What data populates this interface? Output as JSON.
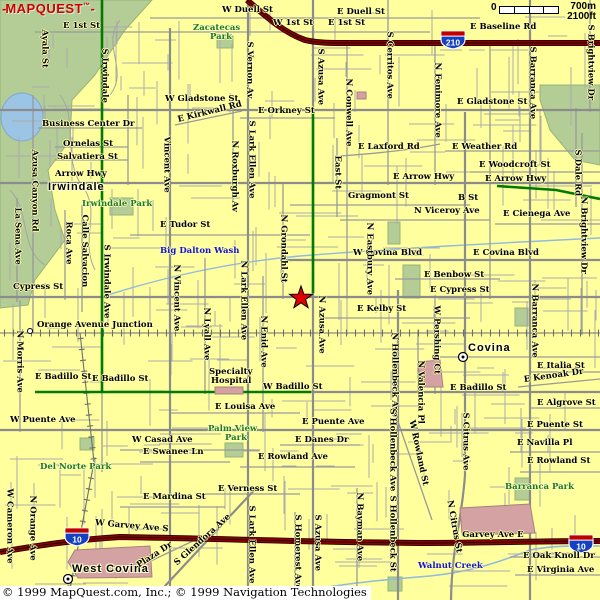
{
  "logo": {
    "prefix": "-",
    "text": "MAPQUEST",
    "tm": "™",
    "suffix": "-"
  },
  "scale": {
    "zero": "0",
    "metric": "700m",
    "imperial": "2100ft"
  },
  "copyright": {
    "text": "© 1999 MapQuest.com, Inc.; © 1999 Navigation Technologies"
  },
  "palette": {
    "background": "#FFFF9E",
    "park": "#B4CC96",
    "water": "#9CC4E4",
    "freeway": "#7E0000",
    "highlight_route": "#007A00",
    "building": "#D4A2A2",
    "road": "#909090",
    "logo_red": "#CC0000",
    "water_text": "#1414CC",
    "park_text": "#1E7A1E"
  },
  "shields": [
    {
      "number": "210",
      "x": 453,
      "y": 40
    },
    {
      "number": "10",
      "x": 77,
      "y": 537
    },
    {
      "number": "10",
      "x": 581,
      "y": 544
    }
  ],
  "star": {
    "x": 301,
    "y": 298
  },
  "markers": [
    {
      "x": 97,
      "y": 186,
      "s": "town"
    },
    {
      "x": 30,
      "y": 331,
      "s": "junction"
    },
    {
      "x": 463,
      "y": 357,
      "s": "city"
    },
    {
      "x": 68,
      "y": 579,
      "s": "city"
    }
  ],
  "labels": [
    {
      "t": "W Duell St",
      "x": 222,
      "y": 6
    },
    {
      "t": "E Duell St",
      "x": 337,
      "y": 8
    },
    {
      "t": "W 1st St",
      "x": 273,
      "y": 19
    },
    {
      "t": "E 1st St",
      "x": 328,
      "y": 19
    },
    {
      "t": "E 1st St",
      "x": 63,
      "y": 22
    },
    {
      "t": "E Baseline Rd",
      "x": 470,
      "y": 23
    },
    {
      "t": "Zacatecas",
      "k": "p",
      "x": 193,
      "y": 24
    },
    {
      "t": "Park",
      "k": "p",
      "x": 210,
      "y": 33
    },
    {
      "t": "W Gladstone St",
      "x": 165,
      "y": 95
    },
    {
      "t": "E Gladstone St",
      "x": 457,
      "y": 98
    },
    {
      "t": "E Orkney St",
      "x": 258,
      "y": 107
    },
    {
      "t": "Business Center Dr",
      "x": 42,
      "y": 120
    },
    {
      "t": "E Kirkwall Rd",
      "x": 178,
      "y": 116,
      "r": -14
    },
    {
      "t": "Ornelas St",
      "x": 63,
      "y": 140
    },
    {
      "t": "Salvatiera St",
      "x": 57,
      "y": 153
    },
    {
      "t": "E Laxford Rd",
      "x": 358,
      "y": 143
    },
    {
      "t": "E Weather Rd",
      "x": 452,
      "y": 143
    },
    {
      "t": "E Woodcroft St",
      "x": 479,
      "y": 161
    },
    {
      "t": "Arrow Hwy",
      "x": 55,
      "y": 170
    },
    {
      "t": "E Arrow Hwy",
      "x": 393,
      "y": 173
    },
    {
      "t": "E Arrow Hwy",
      "x": 485,
      "y": 175
    },
    {
      "t": "Irwindale",
      "k": "c",
      "x": 48,
      "y": 181
    },
    {
      "t": "Irwindale Park",
      "k": "p",
      "x": 82,
      "y": 200
    },
    {
      "t": "Gragmont St",
      "x": 348,
      "y": 192
    },
    {
      "t": "B St",
      "x": 458,
      "y": 194
    },
    {
      "t": "N Viceroy Ave",
      "x": 414,
      "y": 207
    },
    {
      "t": "E Cienega Ave",
      "x": 503,
      "y": 210
    },
    {
      "t": "E Tudor St",
      "x": 160,
      "y": 221
    },
    {
      "t": "Big Dalton Wash",
      "k": "w",
      "x": 160,
      "y": 247
    },
    {
      "t": "W Covina Blvd",
      "x": 353,
      "y": 249
    },
    {
      "t": "E Covina Blvd",
      "x": 473,
      "y": 249
    },
    {
      "t": "E Benbow St",
      "x": 424,
      "y": 271
    },
    {
      "t": "E Cypress St",
      "x": 430,
      "y": 286
    },
    {
      "t": "Cypress St",
      "x": 13,
      "y": 283
    },
    {
      "t": "E Kelby St",
      "x": 357,
      "y": 305
    },
    {
      "t": "Orange Avenue Junction",
      "x": 37,
      "y": 321
    },
    {
      "t": "Covina",
      "k": "c",
      "x": 468,
      "y": 342
    },
    {
      "t": "E Italia St",
      "x": 537,
      "y": 362
    },
    {
      "t": "E Kenoak Dr",
      "x": 524,
      "y": 376,
      "r": -8
    },
    {
      "t": "Specialty",
      "x": 209,
      "y": 368
    },
    {
      "t": "Hospital",
      "x": 211,
      "y": 377
    },
    {
      "t": "E Badillo St",
      "x": 35,
      "y": 373
    },
    {
      "t": "E Badillo St",
      "x": 92,
      "y": 375
    },
    {
      "t": "W Badillo St",
      "x": 263,
      "y": 383
    },
    {
      "t": "E Badillo St",
      "x": 450,
      "y": 384
    },
    {
      "t": "E Louisa Ave",
      "x": 215,
      "y": 403
    },
    {
      "t": "E Algrove St",
      "x": 537,
      "y": 399
    },
    {
      "t": "W Puente Ave",
      "x": 10,
      "y": 416
    },
    {
      "t": "E Puente Ave",
      "x": 302,
      "y": 418
    },
    {
      "t": "E Puente St",
      "x": 527,
      "y": 421
    },
    {
      "t": "Palm View",
      "k": "p",
      "x": 208,
      "y": 425
    },
    {
      "t": "Park",
      "k": "p",
      "x": 225,
      "y": 434
    },
    {
      "t": "W Casad Ave",
      "x": 132,
      "y": 436
    },
    {
      "t": "E Danes Dr",
      "x": 295,
      "y": 436
    },
    {
      "t": "E Navilla Pl",
      "x": 517,
      "y": 439
    },
    {
      "t": "E Swanee Ln",
      "x": 143,
      "y": 448
    },
    {
      "t": "E Rowland Ave",
      "x": 258,
      "y": 453
    },
    {
      "t": "E Rowland St",
      "x": 527,
      "y": 457
    },
    {
      "t": "Del Norte Park",
      "k": "p",
      "x": 40,
      "y": 463
    },
    {
      "t": "E Verness St",
      "x": 218,
      "y": 485
    },
    {
      "t": "Barranca Park",
      "k": "p",
      "x": 505,
      "y": 483
    },
    {
      "t": "E Mardina St",
      "x": 143,
      "y": 493
    },
    {
      "t": "W Garvey Ave S",
      "x": 95,
      "y": 519,
      "r": 5
    },
    {
      "t": "S Garvey Ave E",
      "x": 453,
      "y": 531
    },
    {
      "t": "E Oak Knoll Dr",
      "x": 523,
      "y": 552
    },
    {
      "t": "E Virginia Ave",
      "x": 527,
      "y": 566
    },
    {
      "t": "Walnut Creek",
      "k": "w",
      "x": 418,
      "y": 562
    },
    {
      "t": "West Covina",
      "k": "c",
      "x": 72,
      "y": 563
    },
    {
      "t": "Ayala St",
      "k": "v",
      "x": 44,
      "y": 25
    },
    {
      "t": "S Irwindale",
      "k": "v",
      "x": 104,
      "y": 44
    },
    {
      "t": "S Vernon Av",
      "k": "v",
      "x": 249,
      "y": 37
    },
    {
      "t": "S Azusa Ave",
      "k": "v",
      "x": 320,
      "y": 44
    },
    {
      "t": "S Cerritos Ave",
      "k": "v",
      "x": 389,
      "y": 27
    },
    {
      "t": "N Conwell Ave",
      "k": "v",
      "x": 348,
      "y": 74
    },
    {
      "t": "N Fenimore Ave",
      "k": "v",
      "x": 437,
      "y": 58
    },
    {
      "t": "S Barranca Ave",
      "k": "v",
      "x": 532,
      "y": 42
    },
    {
      "t": "S Brightview Dr",
      "k": "v",
      "x": 590,
      "y": 20
    },
    {
      "t": "Azusa Canyon Rd",
      "k": "v",
      "x": 34,
      "y": 145
    },
    {
      "t": "La Sena Ave",
      "k": "v",
      "x": 17,
      "y": 203
    },
    {
      "t": "Roca Ave",
      "k": "v",
      "x": 68,
      "y": 217
    },
    {
      "t": "Calle Salvacion",
      "k": "v",
      "x": 84,
      "y": 210
    },
    {
      "t": "S Irwindale Ave",
      "k": "v",
      "x": 106,
      "y": 240
    },
    {
      "t": "Vincent Ave",
      "k": "v",
      "x": 166,
      "y": 132
    },
    {
      "t": "N Vincent Ave",
      "k": "v",
      "x": 176,
      "y": 260
    },
    {
      "t": "N Lyall Ave",
      "k": "v",
      "x": 206,
      "y": 303
    },
    {
      "t": "S Lark Ellen Ave",
      "k": "v",
      "x": 251,
      "y": 116
    },
    {
      "t": "N Roxburgh Av",
      "k": "v",
      "x": 234,
      "y": 136
    },
    {
      "t": "N Lark Ellen Ave",
      "k": "v",
      "x": 243,
      "y": 256
    },
    {
      "t": "N Enid Ave",
      "k": "v",
      "x": 263,
      "y": 311
    },
    {
      "t": "N Grondahl St",
      "k": "v",
      "x": 283,
      "y": 210
    },
    {
      "t": "East St",
      "k": "v",
      "x": 337,
      "y": 151
    },
    {
      "t": "N Eastbury Ave",
      "k": "v",
      "x": 369,
      "y": 218
    },
    {
      "t": "N Azusa Ave",
      "k": "v",
      "x": 321,
      "y": 291
    },
    {
      "t": "W Pershing Ct",
      "k": "v",
      "x": 436,
      "y": 301
    },
    {
      "t": "N Hollenbeck Ave",
      "k": "v",
      "x": 394,
      "y": 328
    },
    {
      "t": "S Hollenbeck Ave",
      "k": "v",
      "x": 392,
      "y": 404
    },
    {
      "t": "N Valencia Pl",
      "k": "v",
      "x": 420,
      "y": 356
    },
    {
      "t": "S Citrus Ave",
      "k": "v",
      "x": 465,
      "y": 408
    },
    {
      "t": "N Barranca Ave",
      "k": "v",
      "x": 534,
      "y": 279
    },
    {
      "t": "S Dale Rd",
      "k": "v",
      "x": 577,
      "y": 145
    },
    {
      "t": "N Brightview Dr",
      "k": "v",
      "x": 583,
      "y": 192
    },
    {
      "t": "S Lark Ellen Ave",
      "k": "v",
      "x": 251,
      "y": 501
    },
    {
      "t": "S Homerest Ave",
      "k": "v",
      "x": 297,
      "y": 510
    },
    {
      "t": "S Azusa Ave",
      "k": "v",
      "x": 317,
      "y": 510
    },
    {
      "t": "N Bayman Ave",
      "k": "v",
      "x": 359,
      "y": 488
    },
    {
      "t": "S Hollenbeck St",
      "k": "v",
      "x": 392,
      "y": 491
    },
    {
      "t": "W Cameron Ave",
      "k": "v",
      "x": 9,
      "y": 484
    },
    {
      "t": "N Orange Ave",
      "k": "v",
      "x": 32,
      "y": 491
    },
    {
      "t": "N Morris Ave",
      "k": "v",
      "x": 19,
      "y": 326
    },
    {
      "t": "W Rowland St",
      "k": "v",
      "x": 411,
      "y": 416,
      "r": 78
    },
    {
      "t": "N Citrus St",
      "k": "v",
      "x": 449,
      "y": 496,
      "r": 80
    },
    {
      "t": "S Glendora Ave",
      "x": 176,
      "y": 560,
      "r": -42
    },
    {
      "t": "Plaza Dr",
      "x": 138,
      "y": 562,
      "r": -33
    }
  ]
}
